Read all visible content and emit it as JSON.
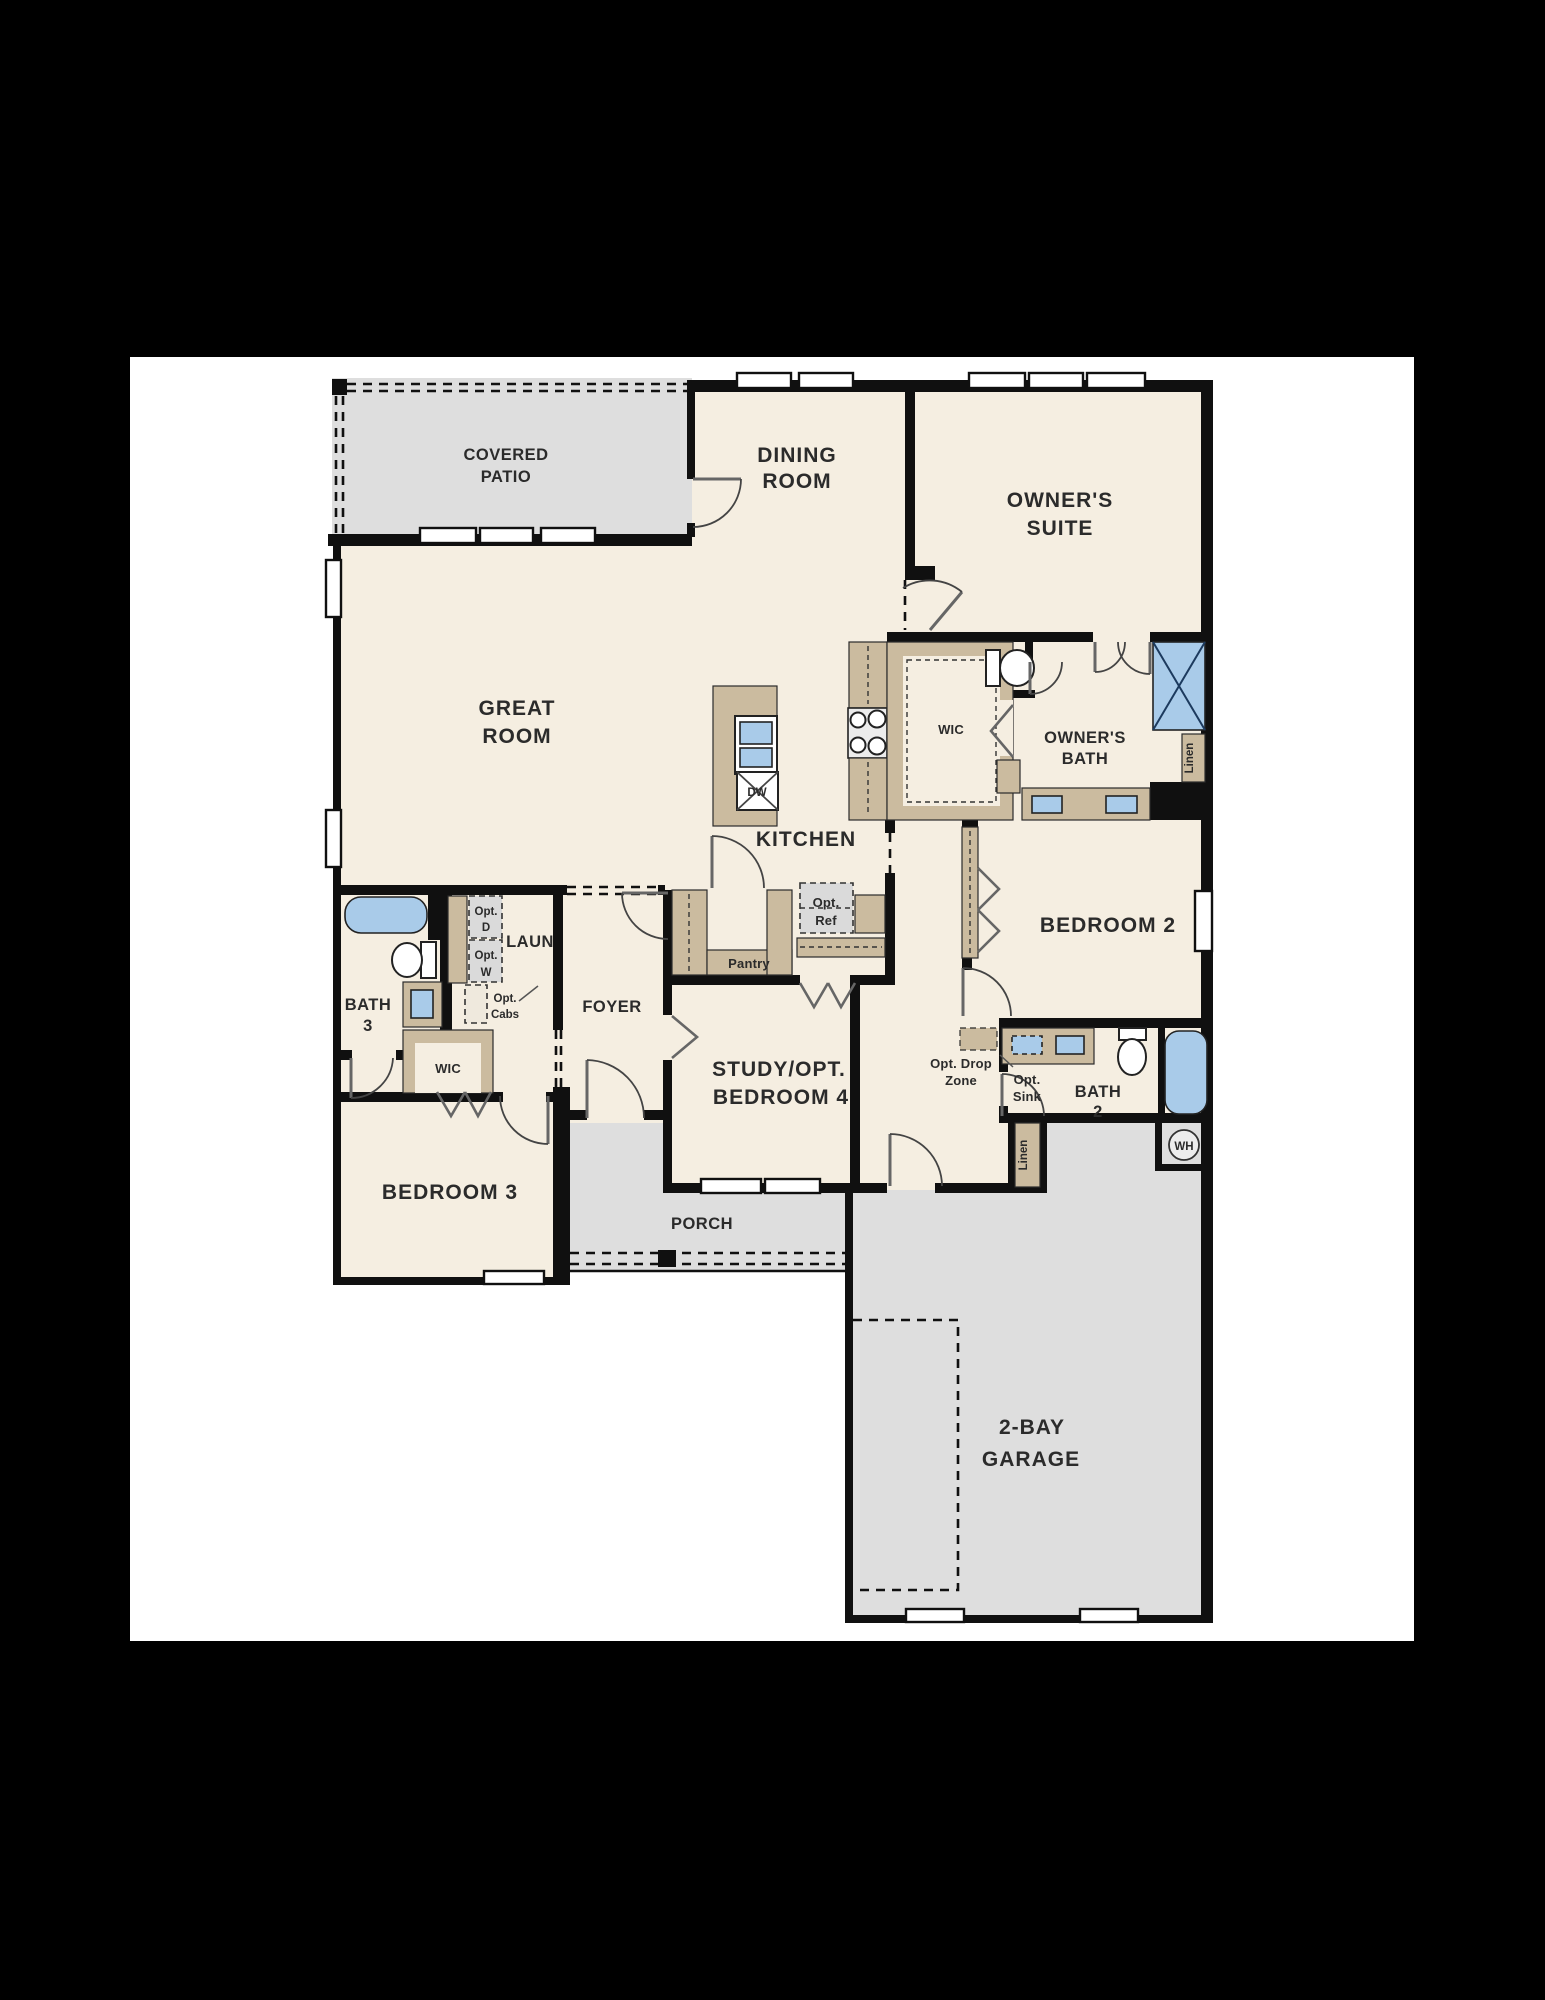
{
  "colors": {
    "background": "#000000",
    "sheet": "#ffffff",
    "floor_cream": "#F5EEE1",
    "outdoor_gray": "#DEDEDE",
    "cabinet_tan": "#CBBB9F",
    "fixture_blue": "#A9CBE9",
    "wall_black": "#101010"
  },
  "rooms": {
    "covered_patio": {
      "l1": "COVERED",
      "l2": "PATIO"
    },
    "dining": {
      "l1": "DINING",
      "l2": "ROOM"
    },
    "great": {
      "l1": "GREAT",
      "l2": "ROOM"
    },
    "owners_suite": {
      "l1": "OWNER'S",
      "l2": "SUITE"
    },
    "kitchen": {
      "label": "KITCHEN"
    },
    "owners_bath": {
      "l1": "OWNER'S",
      "l2": "BATH"
    },
    "wic_owner": {
      "label": "WIC"
    },
    "bedroom2": {
      "label": "BEDROOM 2"
    },
    "bath3": {
      "l1": "BATH",
      "l2": "3"
    },
    "laundry": {
      "label": "LAUN"
    },
    "foyer": {
      "label": "FOYER"
    },
    "study": {
      "l1": "STUDY/OPT.",
      "l2": "BEDROOM 4"
    },
    "wic_hall": {
      "label": "WIC"
    },
    "bedroom3": {
      "label": "BEDROOM 3"
    },
    "porch": {
      "label": "PORCH"
    },
    "bath2": {
      "l1": "BATH",
      "l2": "2"
    },
    "garage": {
      "l1": "2-BAY",
      "l2": "GARAGE"
    }
  },
  "fixtures": {
    "pantry": "Pantry",
    "opt_ref": {
      "l1": "Opt.",
      "l2": "Ref"
    },
    "opt_d": {
      "l1": "Opt.",
      "l2": "D"
    },
    "opt_w": {
      "l1": "Opt.",
      "l2": "W"
    },
    "opt_cabs": {
      "l1": "Opt.",
      "l2": "Cabs"
    },
    "opt_drop": {
      "l1": "Opt. Drop",
      "l2": "Zone"
    },
    "opt_sink": {
      "l1": "Opt.",
      "l2": "Sink"
    },
    "linen_owner": "Linen",
    "linen_hall": "Linen",
    "dw": "DW",
    "wh": "WH"
  }
}
